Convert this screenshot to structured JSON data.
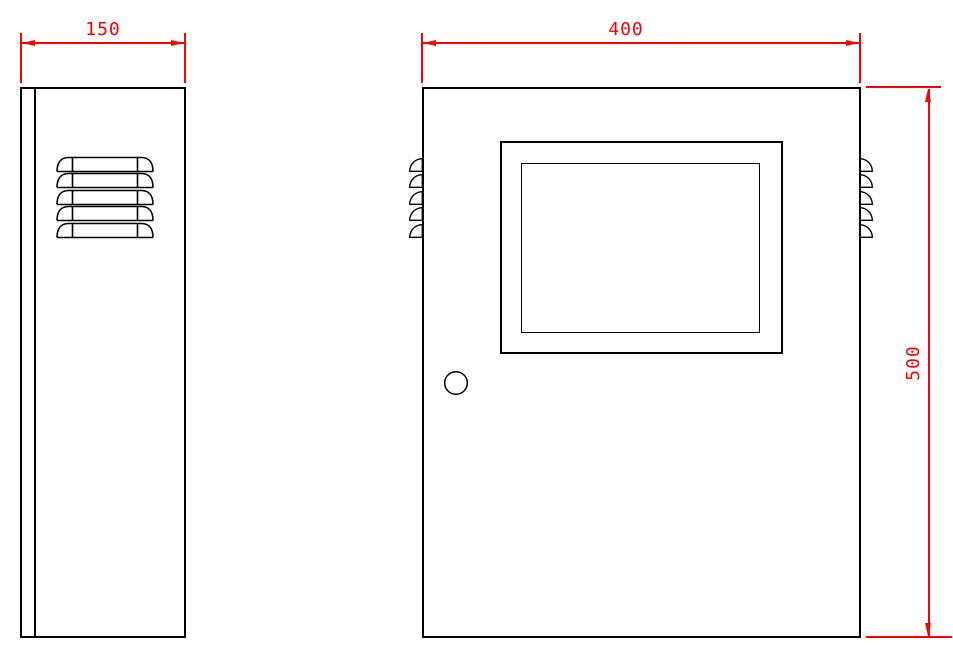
{
  "dimensions": {
    "side_width": "150",
    "front_width": "400",
    "front_height": "500"
  },
  "colors": {
    "dimension_color": "#ff0000",
    "outline_color": "#000000",
    "background_color": "#ffffff"
  },
  "views": {
    "side_view": "cabinet side elevation with 5 louver vents",
    "front_view": "cabinet front elevation with display window, door knob and 5 edge louvers per side"
  }
}
